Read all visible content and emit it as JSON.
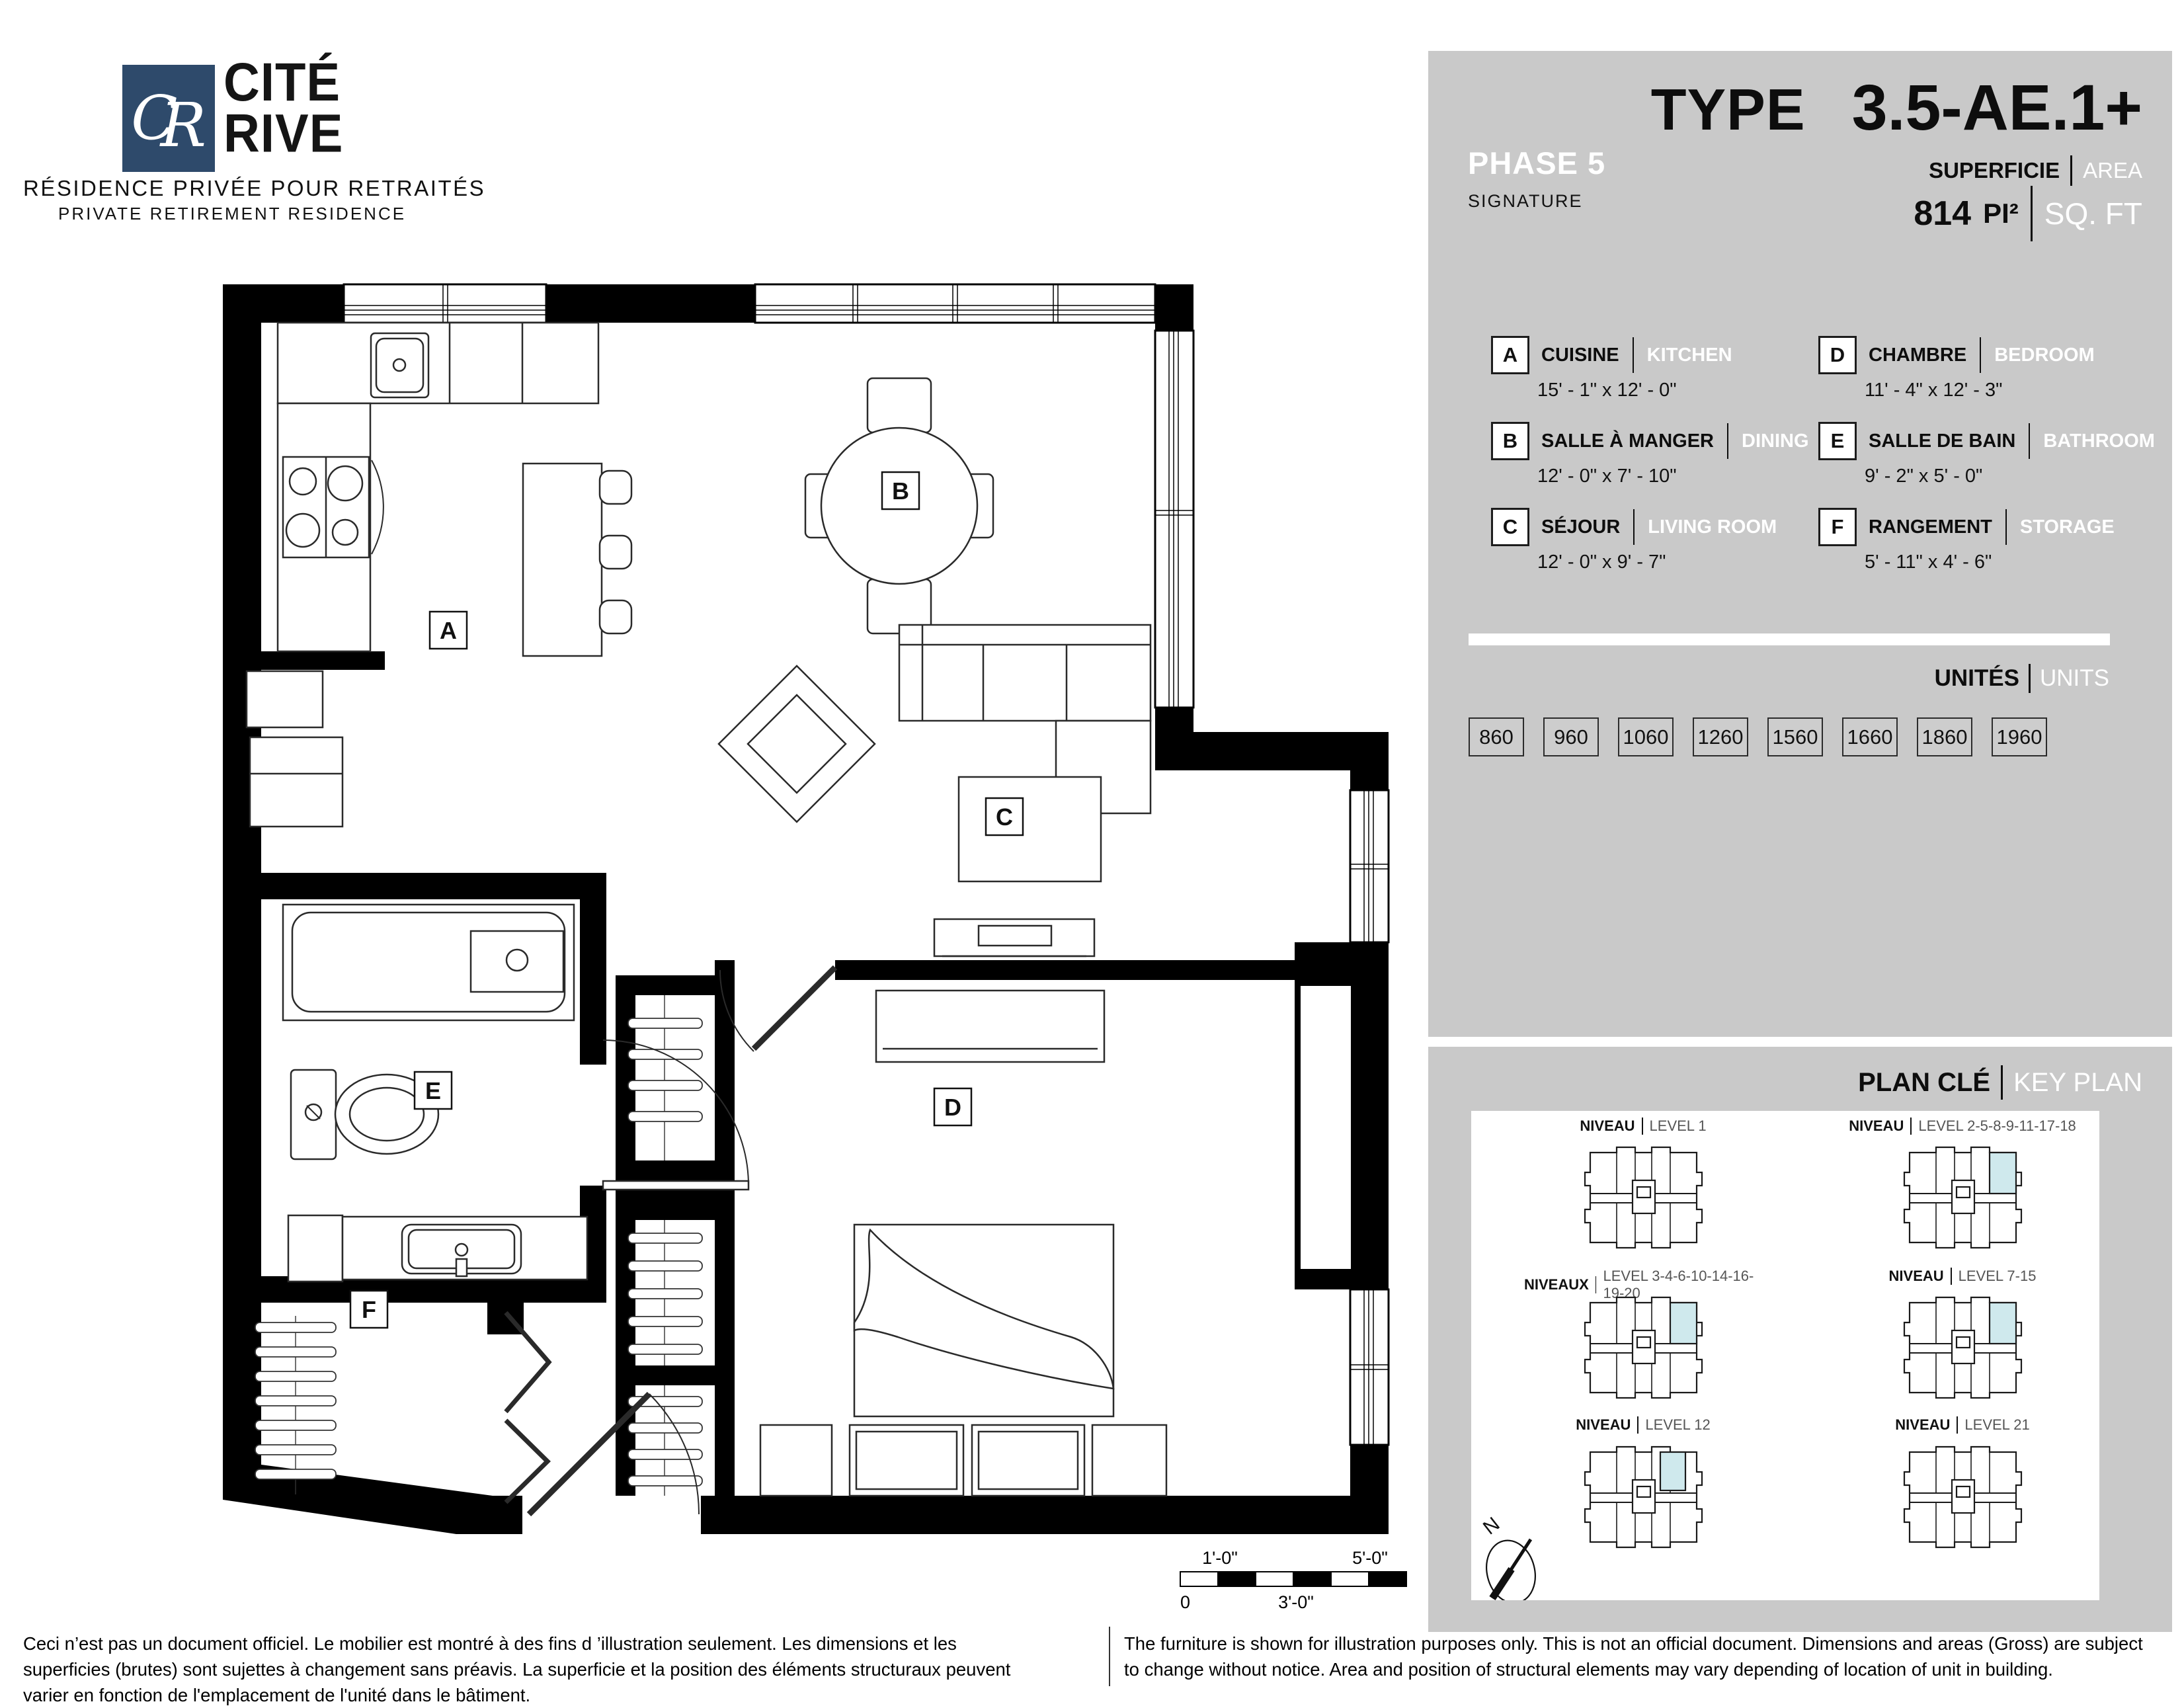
{
  "logo": {
    "initial_c": "C",
    "initial_r": "R",
    "name_line1": "CITÉ",
    "name_line2": "RIVE",
    "tagline_fr": "RÉSIDENCE PRIVÉE POUR RETRAITÉS",
    "tagline_en": "PRIVATE RETIREMENT RESIDENCE"
  },
  "header": {
    "phase": "PHASE 5",
    "collection": "SIGNATURE",
    "type_label": "TYPE",
    "type_value": "3.5-AE.1+",
    "superficie_label": "SUPERFICIE",
    "area_label": "AREA",
    "area_value": "814",
    "area_unit_fr": "PI²",
    "area_unit_en": "SQ. FT"
  },
  "legend": {
    "items": [
      {
        "code": "A",
        "fr": "CUISINE",
        "en": "KITCHEN",
        "dim": "15' - 1\" x 12' - 0\""
      },
      {
        "code": "B",
        "fr": "SALLE À MANGER",
        "en": "DINING",
        "dim": "12' - 0\" x 7' - 10\""
      },
      {
        "code": "C",
        "fr": "SÉJOUR",
        "en": "LIVING ROOM",
        "dim": "12' - 0\" x 9' - 7\""
      },
      {
        "code": "D",
        "fr": "CHAMBRE",
        "en": "BEDROOM",
        "dim": "11' - 4\" x 12' - 3\""
      },
      {
        "code": "E",
        "fr": "SALLE DE BAIN",
        "en": "BATHROOM",
        "dim": "9' - 2\" x 5' - 0\""
      },
      {
        "code": "F",
        "fr": "RANGEMENT",
        "en": "STORAGE",
        "dim": "5' - 11\" x 4' - 6\""
      }
    ]
  },
  "units": {
    "label_fr": "UNITÉS",
    "label_en": "UNITS",
    "values": [
      "860",
      "960",
      "1060",
      "1260",
      "1560",
      "1660",
      "1860",
      "1960"
    ]
  },
  "keyplan": {
    "title_fr": "PLAN CLÉ",
    "title_en": "KEY PLAN",
    "north_label": "N",
    "levels": [
      {
        "fr": "NIVEAU",
        "en": "LEVEL 1",
        "highlight": false
      },
      {
        "fr": "NIVEAU",
        "en": "LEVEL 2-5-8-9-11-17-18",
        "highlight": true
      },
      {
        "fr": "NIVEAUX",
        "en": "LEVEL 3-4-6-10-14-16-19-20",
        "highlight": true
      },
      {
        "fr": "NIVEAU",
        "en": "LEVEL 7-15",
        "highlight": true
      },
      {
        "fr": "NIVEAU",
        "en": "LEVEL 12",
        "highlight": true
      },
      {
        "fr": "NIVEAU",
        "en": "LEVEL 21",
        "highlight": false
      }
    ]
  },
  "plan": {
    "room_labels": [
      "A",
      "B",
      "C",
      "D",
      "E",
      "F"
    ],
    "scale_bar": {
      "top_left": "1'-0\"",
      "top_right": "5'-0\"",
      "bottom_left": "0",
      "bottom_center": "3'-0\""
    }
  },
  "disclaimer": {
    "fr": "Ceci n’est pas un document officiel.  Le mobilier est montré à des fins d ’illustration seulement.  Les dimensions et les superficies (brutes) sont sujettes à changement sans préavis. La superficie et la position des éléments structuraux peuvent varier en fonction de l'emplacement de l'unité dans le bâtiment.",
    "en": "The furniture is shown for illustration purposes only.  This is not an official document.  Dimensions and areas (Gross) are subject to change without notice.  Area and position of structural elements may vary depending of location of unit in building."
  },
  "colors": {
    "panel_gray": "#c9c9c9",
    "highlight": "#cfe9ed",
    "navy": "#2e4a6b",
    "wall_black": "#000000"
  }
}
